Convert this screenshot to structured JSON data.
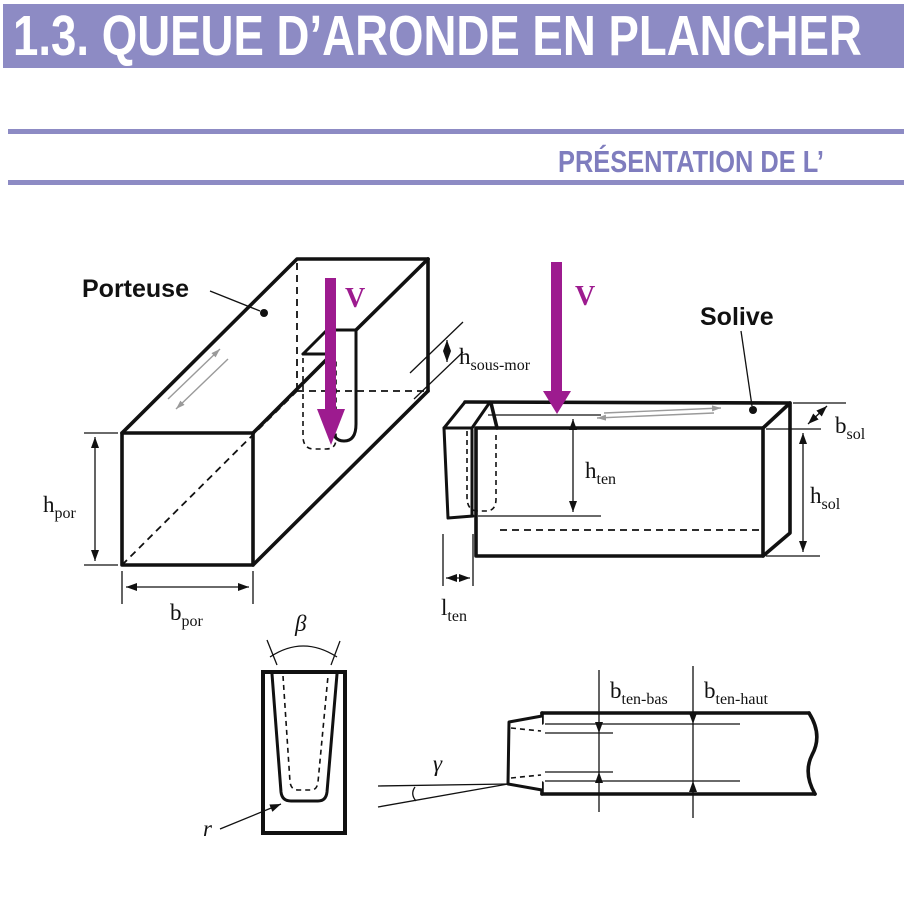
{
  "header": {
    "title": "1.3. QUEUE D’ARONDE EN PLANCHER",
    "section": "PRÉSENTATION DE L’"
  },
  "colors": {
    "banner": "#8d8bc4",
    "rule": "#8d8bc4",
    "section_text": "#7f7dbe",
    "force_arrow": "#9d1b8f",
    "line": "#111111"
  },
  "figure": {
    "labels": {
      "porteuse": "Porteuse",
      "solive": "Solive",
      "force_porteuse": "V",
      "force_solive": "V"
    },
    "dims": {
      "h_por": {
        "main": "h",
        "sub": "por"
      },
      "b_por": {
        "main": "b",
        "sub": "por"
      },
      "h_sous_mor": {
        "main": "h",
        "sub": "sous-mor"
      },
      "b_sol": {
        "main": "b",
        "sub": "sol"
      },
      "h_sol": {
        "main": "h",
        "sub": "sol"
      },
      "h_ten": {
        "main": "h",
        "sub": "ten"
      },
      "l_ten": {
        "main": "l",
        "sub": "ten"
      },
      "b_ten_bas": {
        "main": "b",
        "sub": "ten-bas"
      },
      "b_ten_haut": {
        "main": "b",
        "sub": "ten-haut"
      }
    },
    "symbols": {
      "beta": "β",
      "gamma": "γ",
      "radius": "r"
    }
  }
}
